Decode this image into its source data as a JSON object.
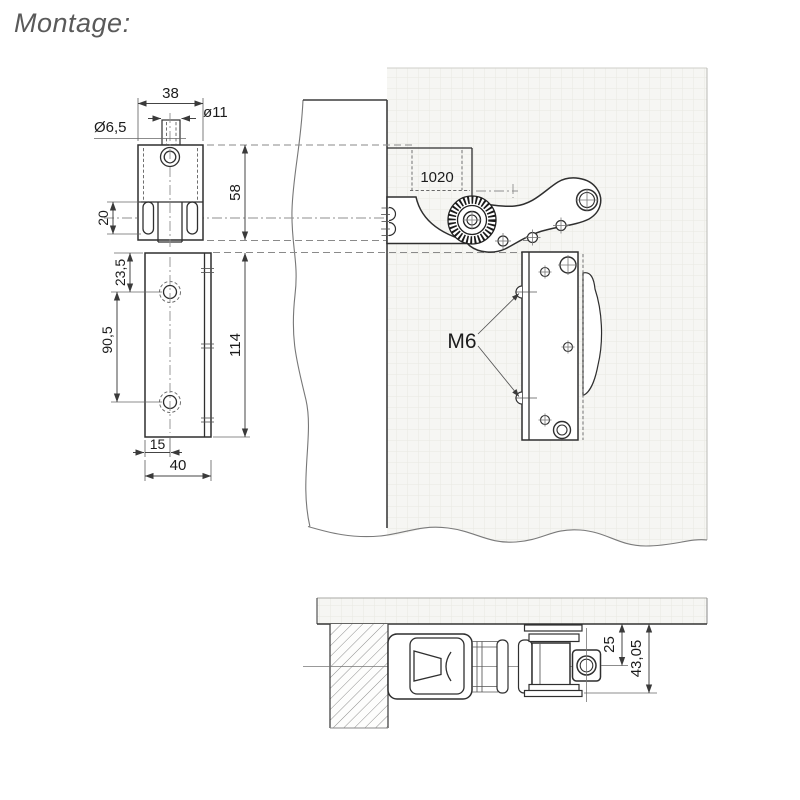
{
  "title": "Montage:",
  "colors": {
    "line": "#2f2f2f",
    "dim_line": "#444444",
    "dash_line": "#8a8a8a",
    "panel_fill": "#f6f6f3",
    "panel_grid": "#e8e8e2",
    "title_text": "#5a5a5a",
    "text": "#1c1c1c"
  },
  "views": {
    "bracket_front": {
      "width": "38",
      "pin_boss_dia": "ø11",
      "hole_dia": "Ø6,5",
      "height": "58",
      "slot_length": "20"
    },
    "plate_front": {
      "first_hole_offset": "23,5",
      "hole_spacing": "90,5",
      "height": "114",
      "hole_edge_offset": "15",
      "width": "40"
    },
    "assembly_side": {
      "part_number": "1020",
      "screw_label": "M6"
    },
    "assembly_top": {
      "axis_offset": "25",
      "overall_depth": "43,05"
    }
  }
}
